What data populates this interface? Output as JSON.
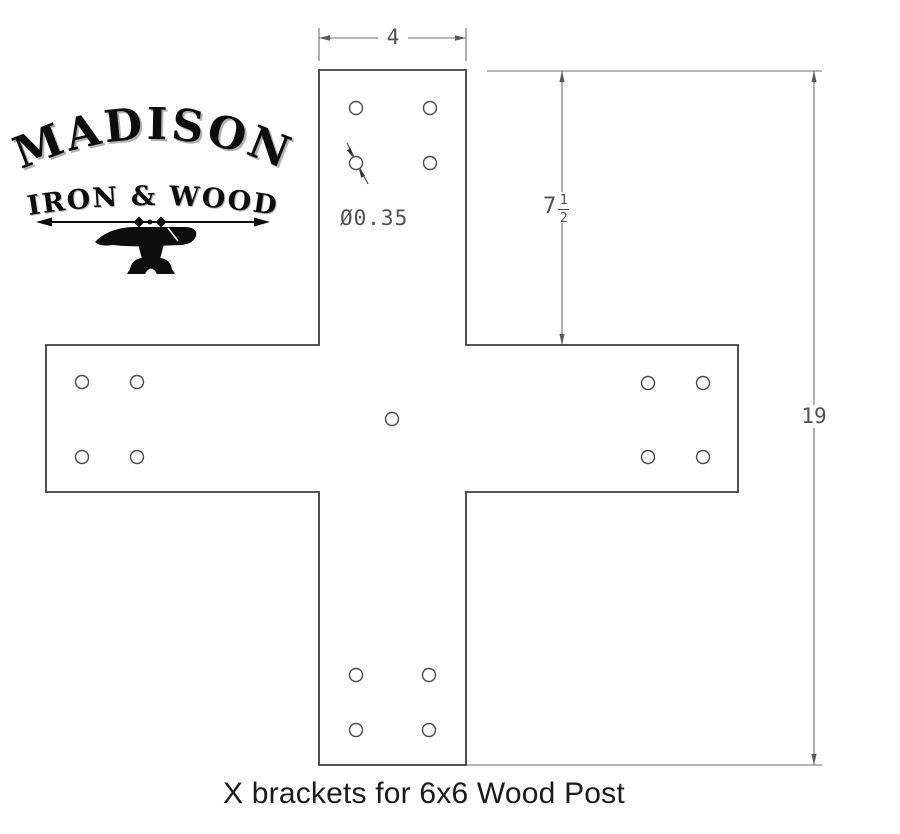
{
  "logo": {
    "title": "MADISON",
    "subtitle": "IRON & WOOD"
  },
  "dimensions": {
    "top_width": "4",
    "upper_height_whole": "7",
    "upper_height_numerator": "1",
    "upper_height_denominator": "2",
    "total_height": "19",
    "hole_diameter_callout": "Ø0.35"
  },
  "caption": "X brackets for 6x6 Wood Post",
  "drawing": {
    "shape": "cross-bracket",
    "outline_path": "M319,70 H466 V345 H738 V492 H466 V765 H319 V492 H46 V345 H319 Z",
    "hole_radius": 6.5,
    "holes": [
      [
        356,
        108
      ],
      [
        430,
        108
      ],
      [
        356,
        163
      ],
      [
        430,
        163
      ],
      [
        82,
        382
      ],
      [
        137,
        382
      ],
      [
        82,
        457
      ],
      [
        137,
        457
      ],
      [
        648,
        383
      ],
      [
        703,
        383
      ],
      [
        648,
        457
      ],
      [
        703,
        457
      ],
      [
        356,
        675
      ],
      [
        429,
        675
      ],
      [
        356,
        730
      ],
      [
        429,
        730
      ],
      [
        392,
        419
      ]
    ]
  },
  "colors": {
    "outline": "#3e3e3e",
    "dimension_lines": "#6e6e6e",
    "dimension_text": "#4f4f4f",
    "logo_ink": "#0d0d0d",
    "caption_text": "#1b1b1b"
  }
}
